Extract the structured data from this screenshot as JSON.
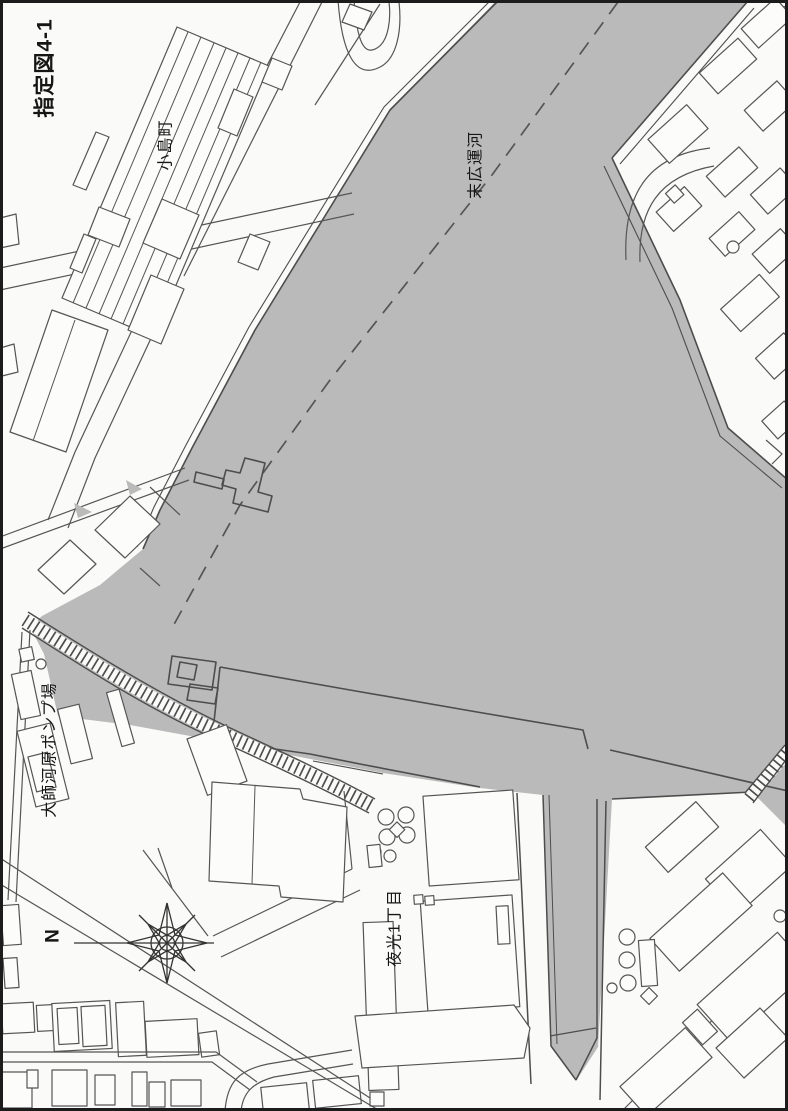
{
  "map": {
    "title": "指定図4-1",
    "labels": {
      "north_district": "小島町",
      "canal": "末広運河",
      "pump_station": "大師河原ポンプ場",
      "south_district": "夜光1丁目",
      "compass_north": "N"
    },
    "colors": {
      "designated_area": "#bababa",
      "linework": "#4d4d4d",
      "strong_line": "#3c3c3c",
      "background": "#fafaf8",
      "frame": "#1c1c1c"
    }
  }
}
